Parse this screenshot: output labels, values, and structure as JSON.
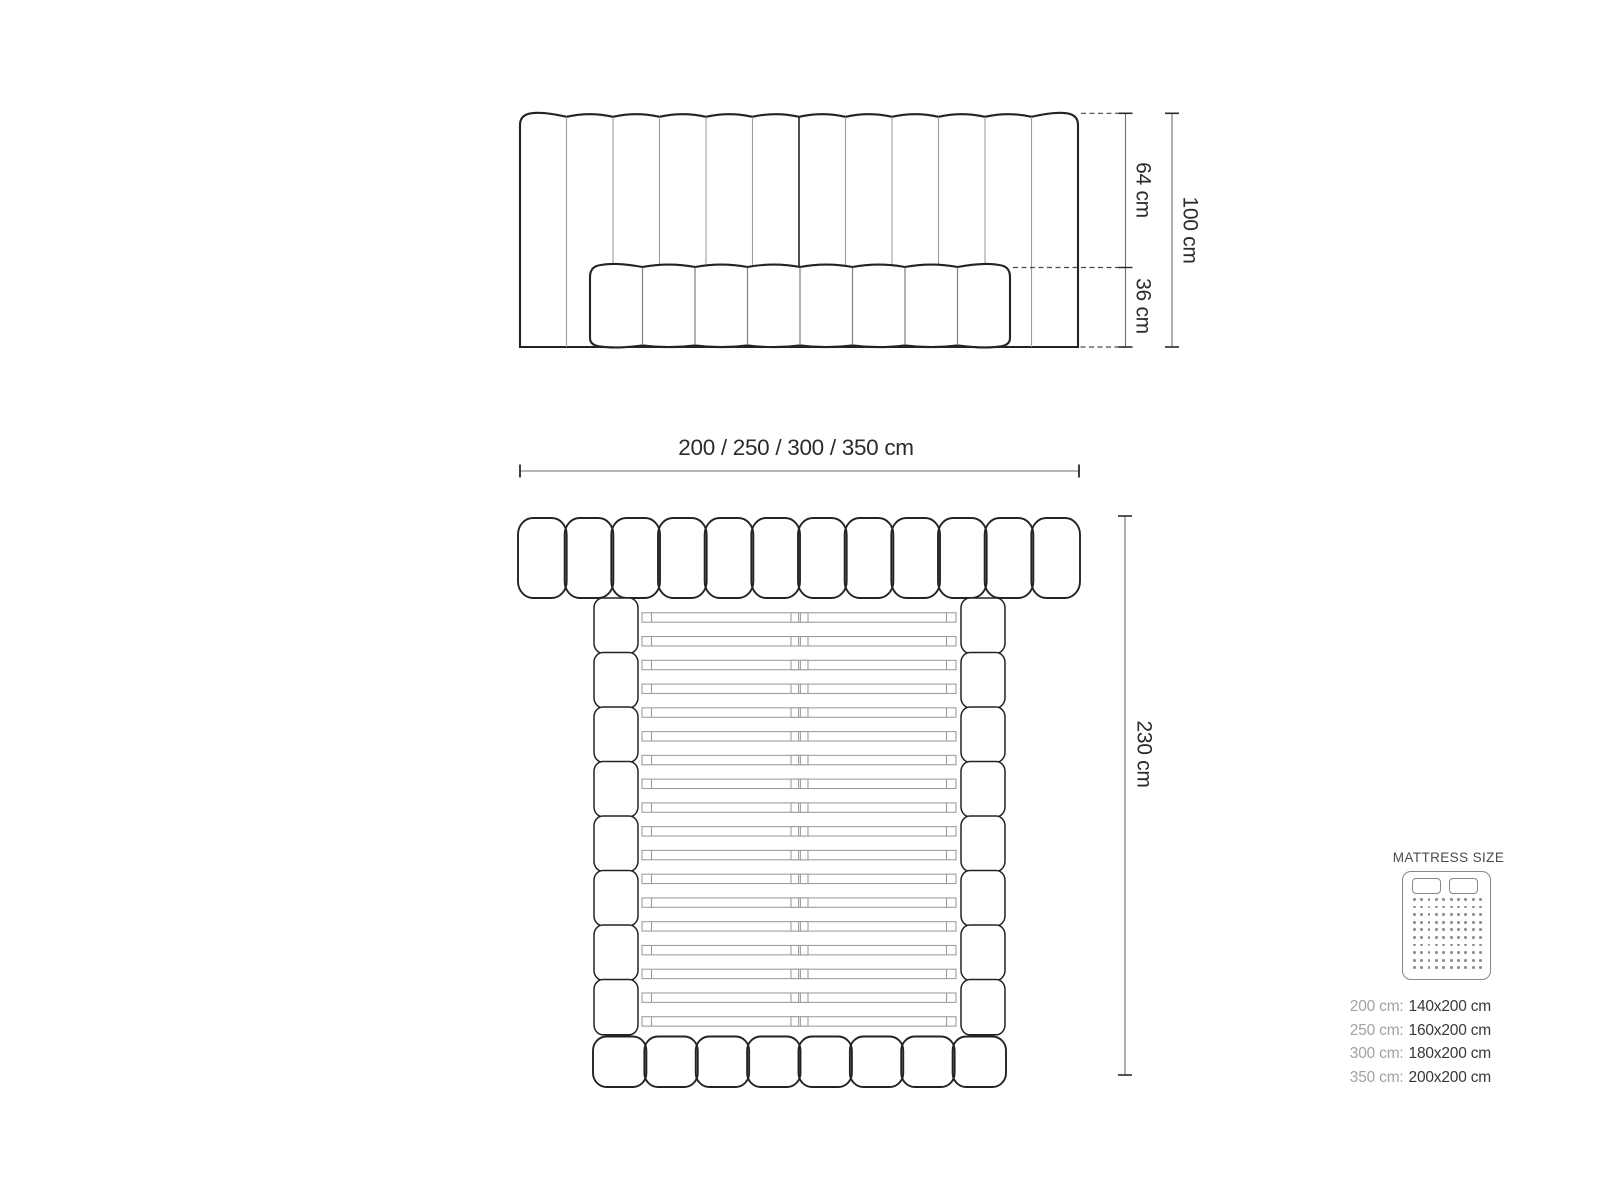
{
  "front_view": {
    "dim_upper_label": "64 cm",
    "dim_lower_label": "36 cm",
    "dim_total_label": "100 cm",
    "headboard_channels": 12,
    "mattress_cushions": 8
  },
  "width_dimension": {
    "label": "200 / 250 / 300 / 350 cm"
  },
  "top_view": {
    "dim_length_label": "230 cm",
    "headboard_pills": 12,
    "rail_segments_per_side": 8,
    "slats": 18,
    "footboard_cushions": 8
  },
  "legend": {
    "title": "MATTRESS SIZE",
    "icon": {
      "name": "double-mattress-icon",
      "pillows": 2,
      "dot_rows": 10,
      "dot_cols": 10
    },
    "sizes": [
      {
        "label": "200 cm:",
        "value": "140x200 cm"
      },
      {
        "label": "250 cm:",
        "value": "160x200 cm"
      },
      {
        "label": "300 cm:",
        "value": "180x200 cm"
      },
      {
        "label": "350 cm:",
        "value": "200x200 cm"
      }
    ]
  },
  "colors": {
    "background": "#ffffff",
    "outline": "#232323",
    "channel_divider": "#9e9e9e",
    "center_divider": "#2e2e2e",
    "cushion_divider": "#7e7e7e",
    "slat_stroke": "#9b9b9b",
    "dim_line": "#6e6e6e",
    "dim_tick": "#2b2b2b",
    "dash_line": "#4a4a4a",
    "text": "#2b2b2b",
    "legend_label": "#a2a2a2",
    "legend_value": "#373737",
    "legend_icon": "#878787"
  }
}
